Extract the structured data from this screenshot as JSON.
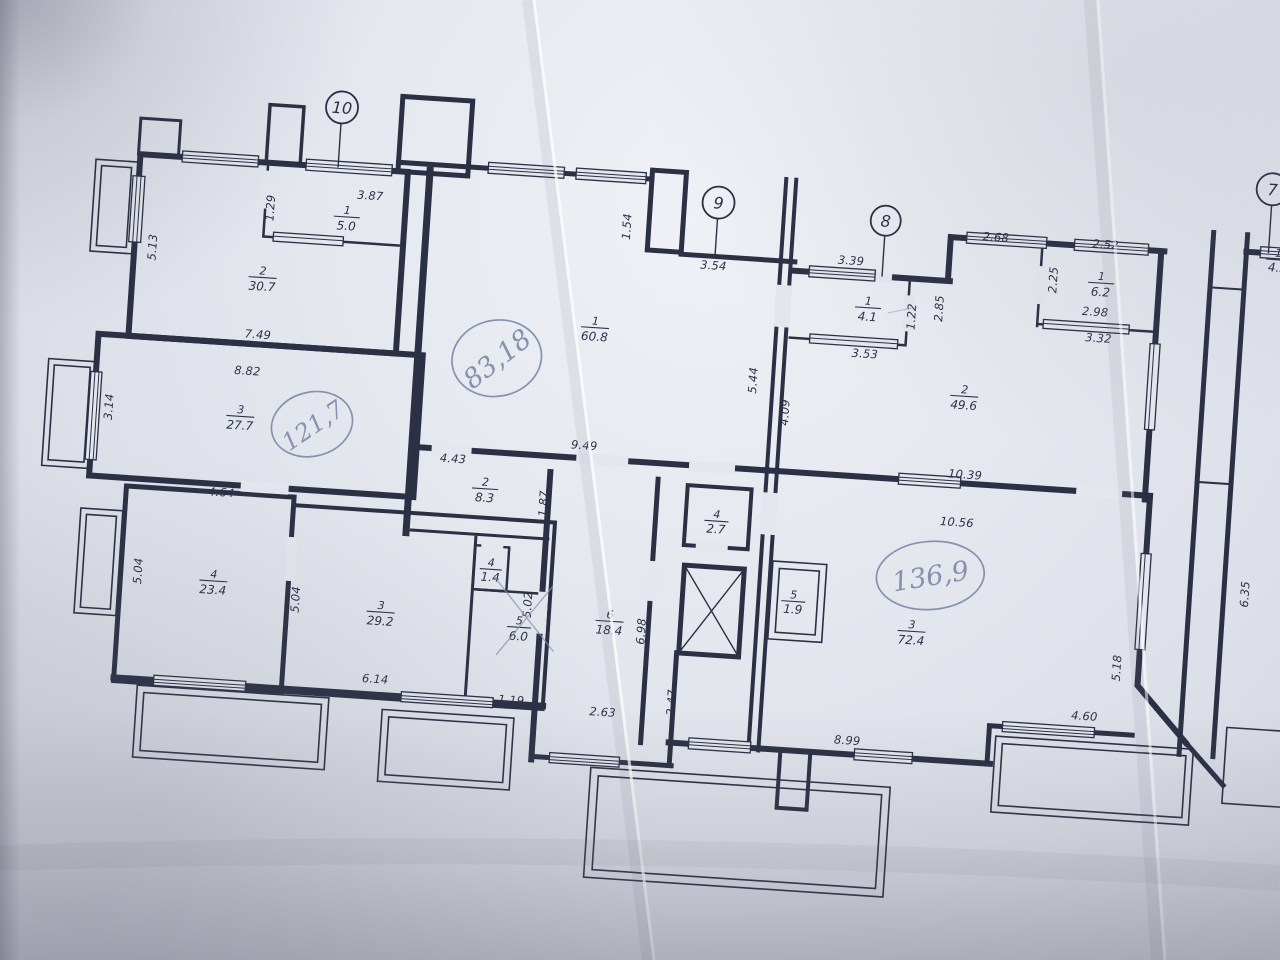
{
  "colors": {
    "ink": "#2b3044",
    "pencil": "#8691ad",
    "paper": "#e4e7ee"
  },
  "section_markers": {
    "m10": "10",
    "m9": "9",
    "m8": "8",
    "m7": "7"
  },
  "handwritten": {
    "hw_left": "121,7",
    "hw_center": "83,18",
    "hw_right": "136,9"
  },
  "rooms": {
    "l_5_0": {
      "n": "1",
      "a": "5.0"
    },
    "l_30_7": {
      "n": "2",
      "a": "30.7"
    },
    "l_27_7": {
      "n": "3",
      "a": "27.7"
    },
    "l_23_4": {
      "n": "4",
      "a": "23.4"
    },
    "l_29_2": {
      "n": "3",
      "a": "29.2"
    },
    "l_8_3": {
      "n": "2",
      "a": "8.3"
    },
    "l_1_4": {
      "n": "4",
      "a": "1.4"
    },
    "l_6_0": {
      "n": "5",
      "a": "6.0"
    },
    "m_60_8": {
      "n": "1",
      "a": "60.8"
    },
    "m_18_4": {
      "n": "6",
      "a": "18.4"
    },
    "m_2_7": {
      "n": "4",
      "a": "2.7"
    },
    "m_1_9": {
      "n": "5",
      "a": "1.9"
    },
    "r_4_1": {
      "n": "1",
      "a": "4.1"
    },
    "r_6_2": {
      "n": "1",
      "a": "6.2"
    },
    "r_49_6": {
      "n": "2",
      "a": "49.6"
    },
    "r_72_4": {
      "n": "3",
      "a": "72.4"
    },
    "fr_4_5": {
      "n": "1",
      "a": "4.5"
    }
  },
  "dims": {
    "d387": "3.87",
    "d129": "1.29",
    "d513": "5.13",
    "d749": "7.49",
    "d882": "8.82",
    "d314": "3.14",
    "d464": "4.64",
    "d504a": "5.04",
    "d504b": "5.04",
    "d614": "6.14",
    "d119": "1.19",
    "d443": "4.43",
    "d187": "1.87",
    "d502": "5.02",
    "d154": "1.54",
    "d949": "9.49",
    "d354": "3.54",
    "d544": "5.44",
    "d698": "6.98",
    "d263": "2.63",
    "d247": "2.47",
    "d339": "3.39",
    "d122": "1.22",
    "d353": "3.53",
    "d285": "2.85",
    "d268": "2.68",
    "d252": "2.52",
    "d225": "2.25",
    "d298": "2.98",
    "d332": "3.32",
    "d409": "4.09",
    "d1039": "10.39",
    "d1056": "10.56",
    "d518": "5.18",
    "d460": "4.60",
    "d899": "8.99",
    "d635": "6.35"
  }
}
